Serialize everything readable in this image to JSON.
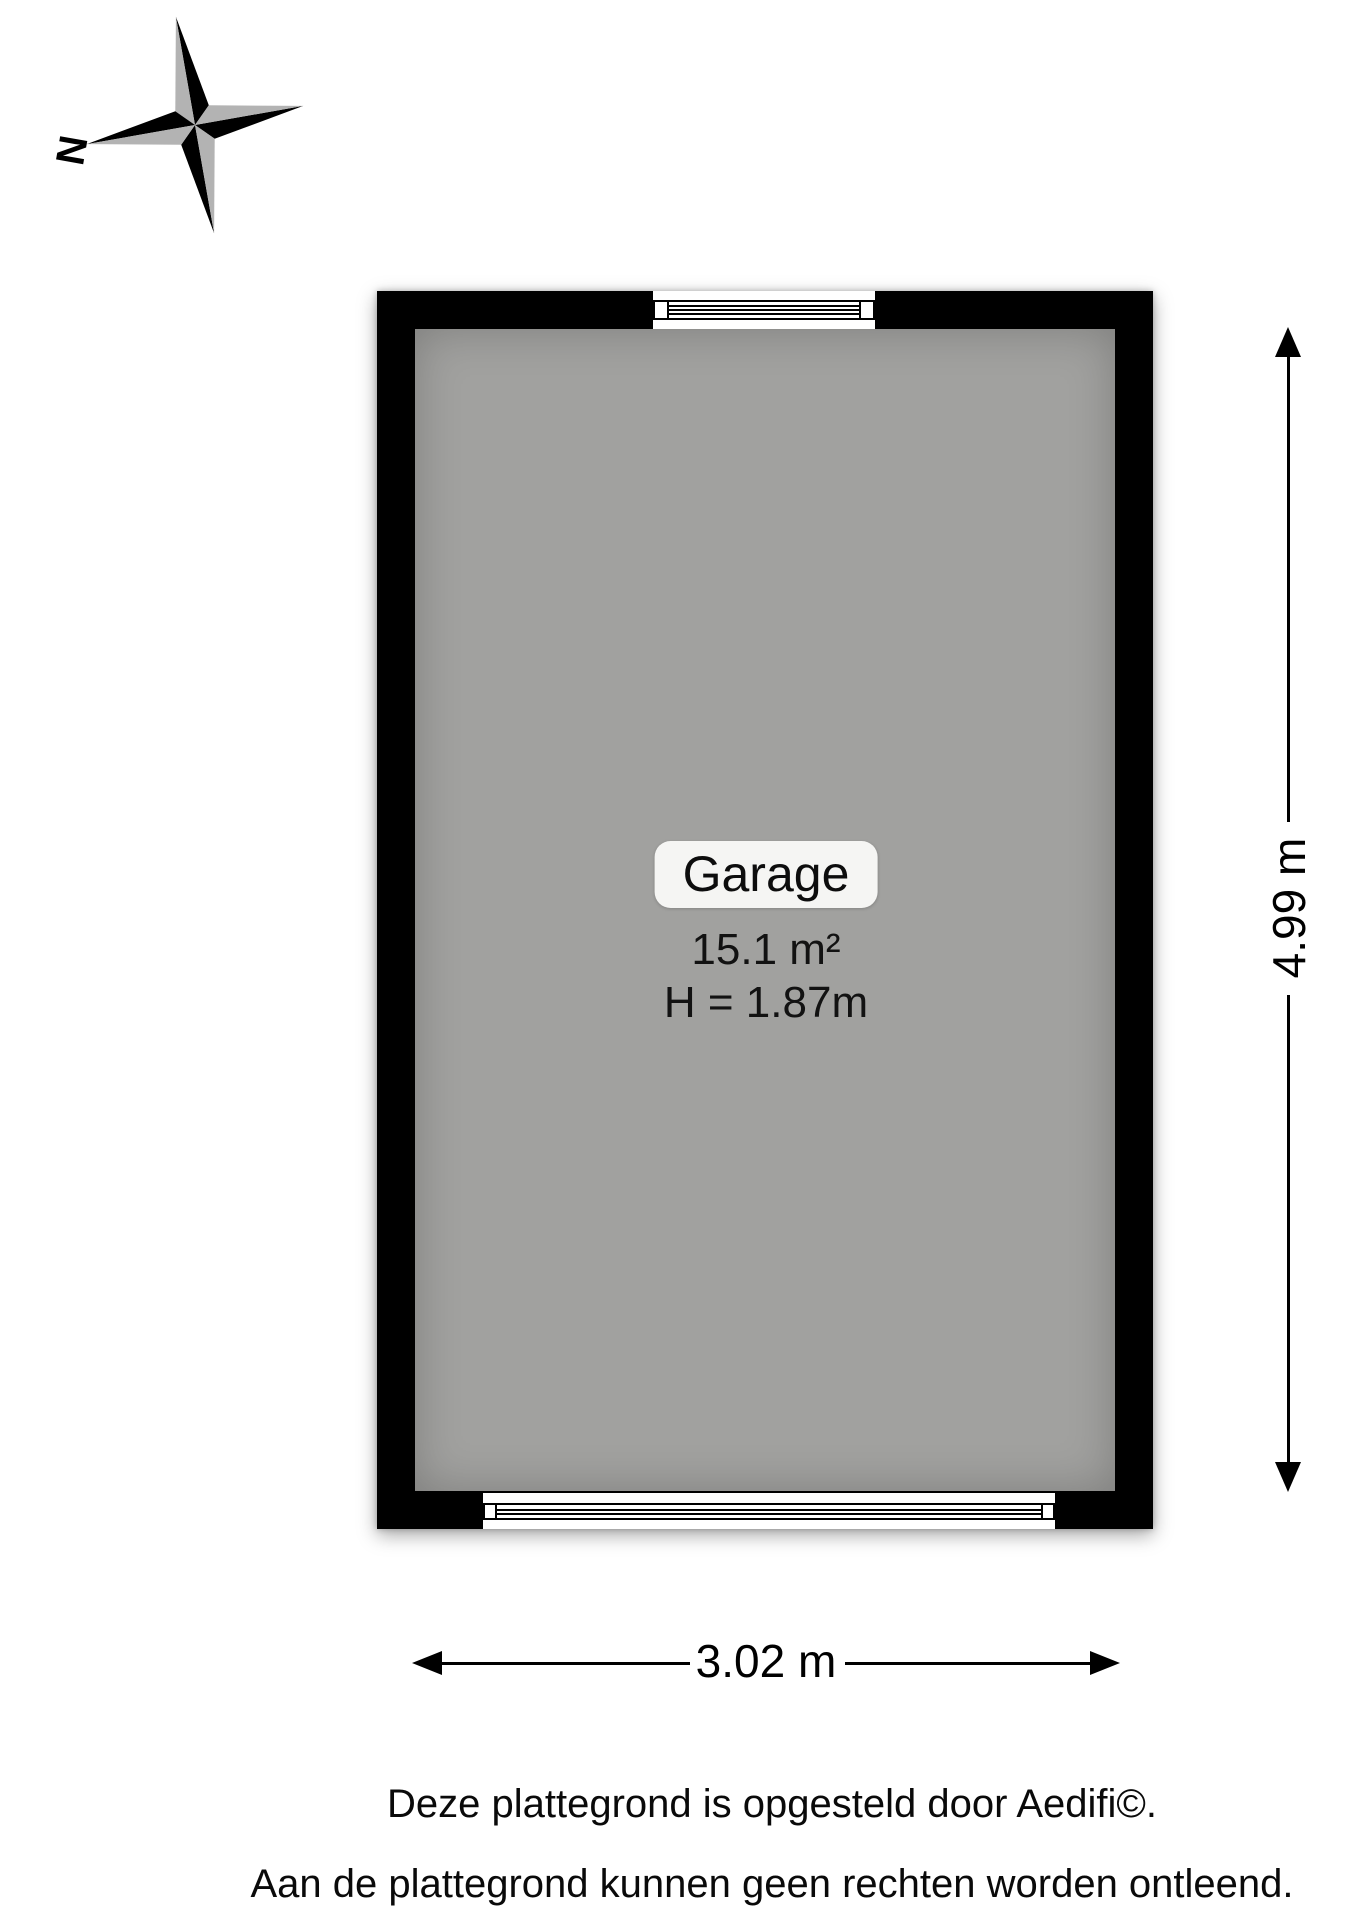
{
  "compass": {
    "label": "N"
  },
  "plan": {
    "room": {
      "name": "Garage",
      "area": "15.1 m²",
      "ceiling_height": "H = 1.87m"
    }
  },
  "dimensions": {
    "vertical": "4.99 m",
    "horizontal": "3.02 m"
  },
  "footer": {
    "line1": "Deze plattegrond is opgesteld door Aedifi©.",
    "line2": "Aan de plattegrond kunnen geen rechten worden ontleend."
  },
  "colors": {
    "wall": "#000000",
    "floor": "#a1a19f",
    "label_background": "#f5f5f3",
    "compass_dark": "#000000",
    "compass_light": "#b3b3b3"
  }
}
